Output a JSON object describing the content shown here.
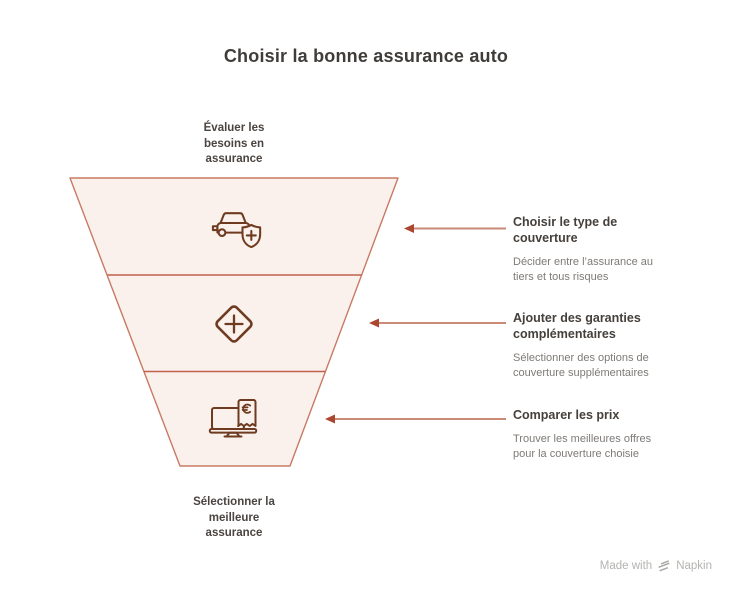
{
  "title": "Choisir la bonne assurance auto",
  "funnel": {
    "top_label": "Évaluer les besoins en assurance",
    "bottom_label": "Sélectionner la meilleure assurance",
    "stages": [
      {
        "icon": "car-shield-icon"
      },
      {
        "icon": "diamond-plus-icon"
      },
      {
        "icon": "monitor-euro-receipt-icon"
      }
    ]
  },
  "steps": [
    {
      "heading": "Choisir le type de couverture",
      "description": "Décider entre l’assurance au tiers et tous risques"
    },
    {
      "heading": "Ajouter des garanties complémentaires",
      "description": "Sélectionner des options de couverture supplémentaires"
    },
    {
      "heading": "Comparer les prix",
      "description": "Trouver les meilleures offres pour la couverture choisie"
    }
  ],
  "footer": {
    "made_with": "Made with",
    "brand": "Napkin",
    "logo_icon": "napkin-flash-icon"
  },
  "colors": {
    "title_text": "#3f3c3a",
    "label_text": "#4b4440",
    "heading_text": "#45403c",
    "body_text": "#7e7a77",
    "funnel_fill": "#faf1ed",
    "funnel_border": "#c87a63",
    "divider": "#c2614b",
    "icon_stroke": "#6e3b20",
    "arrow_line": "#c98b76",
    "arrow_head": "#ab4630",
    "footer_text": "#b5b3b1"
  }
}
